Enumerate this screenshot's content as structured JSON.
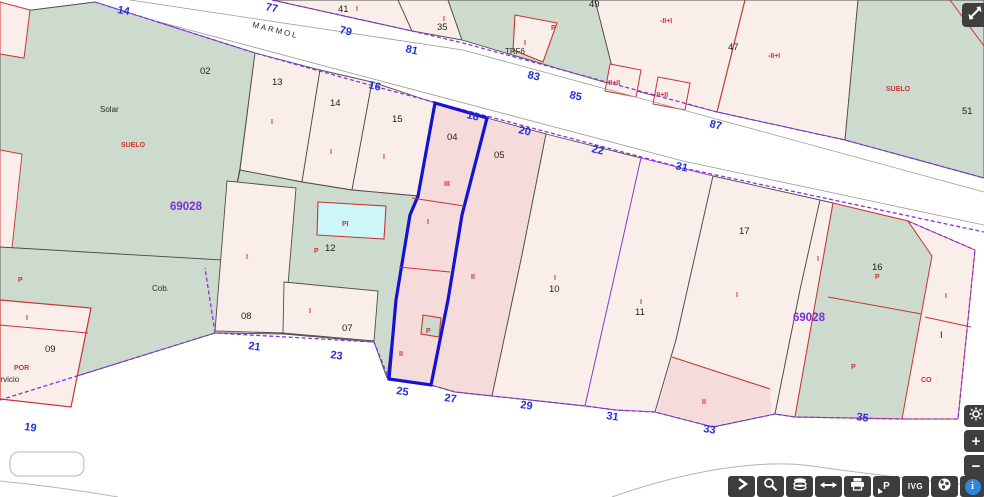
{
  "map": {
    "street_name": "MARMOL",
    "block_number": "69028",
    "colors": {
      "parcel_green": "#ccdbce",
      "parcel_pink": "#faeeeb",
      "parcel_pink_dark": "#f5dcda",
      "pool_cyan": "#cdf7f7",
      "boundary_purple": "#8833dd",
      "selected_blue": "#1512d0",
      "red_line": "#cc3333",
      "label_blue": "#2331d8",
      "label_red": "#d03131",
      "label_purple": "#7b2fd6"
    },
    "labels": {
      "street_numbers": [
        {
          "t": "14",
          "x": 117,
          "y": 13,
          "r": 10
        },
        {
          "t": "77",
          "x": 265,
          "y": 10,
          "r": 12
        },
        {
          "t": "79",
          "x": 339,
          "y": 33,
          "r": 13
        },
        {
          "t": "81",
          "x": 405,
          "y": 52,
          "r": 13
        },
        {
          "t": "83",
          "x": 527,
          "y": 78,
          "r": 13
        },
        {
          "t": "85",
          "x": 569,
          "y": 98,
          "r": 13
        },
        {
          "t": "87",
          "x": 709,
          "y": 127,
          "r": 13
        },
        {
          "t": "16",
          "x": 368,
          "y": 88,
          "r": 13
        },
        {
          "t": "18",
          "x": 466,
          "y": 118,
          "r": 13
        },
        {
          "t": "20",
          "x": 518,
          "y": 133,
          "r": 13
        },
        {
          "t": "22",
          "x": 591,
          "y": 152,
          "r": 13
        },
        {
          "t": "31",
          "x": 675,
          "y": 169,
          "r": 13
        },
        {
          "t": "21",
          "x": 248,
          "y": 349,
          "r": 8
        },
        {
          "t": "23",
          "x": 330,
          "y": 358,
          "r": 8
        },
        {
          "t": "25",
          "x": 396,
          "y": 394,
          "r": 8
        },
        {
          "t": "27",
          "x": 444,
          "y": 401,
          "r": 8
        },
        {
          "t": "29",
          "x": 520,
          "y": 408,
          "r": 8
        },
        {
          "t": "31",
          "x": 606,
          "y": 419,
          "r": 8
        },
        {
          "t": "33",
          "x": 703,
          "y": 432,
          "r": 8
        },
        {
          "t": "35",
          "x": 856,
          "y": 420,
          "r": 8
        },
        {
          "t": "19",
          "x": 24,
          "y": 430,
          "r": 8
        }
      ],
      "parcel_numbers": [
        {
          "t": "02",
          "x": 200,
          "y": 74
        },
        {
          "t": "13",
          "x": 272,
          "y": 85
        },
        {
          "t": "14",
          "x": 330,
          "y": 106
        },
        {
          "t": "15",
          "x": 392,
          "y": 122
        },
        {
          "t": "04",
          "x": 447,
          "y": 140
        },
        {
          "t": "05",
          "x": 494,
          "y": 158
        },
        {
          "t": "10",
          "x": 549,
          "y": 292
        },
        {
          "t": "11",
          "x": 635,
          "y": 315
        },
        {
          "t": "17",
          "x": 739,
          "y": 234
        },
        {
          "t": "16",
          "x": 872,
          "y": 270
        },
        {
          "t": "08",
          "x": 241,
          "y": 319
        },
        {
          "t": "07",
          "x": 342,
          "y": 331
        },
        {
          "t": "09",
          "x": 45,
          "y": 352
        },
        {
          "t": "12",
          "x": 325,
          "y": 251
        },
        {
          "t": "41",
          "x": 338,
          "y": 12
        },
        {
          "t": "35",
          "x": 437,
          "y": 30
        },
        {
          "t": "49",
          "x": 589,
          "y": 7
        },
        {
          "t": "47",
          "x": 728,
          "y": 50
        },
        {
          "t": "51",
          "x": 962,
          "y": 114
        },
        {
          "t": "I",
          "x": 940,
          "y": 338
        }
      ],
      "area_labels": [
        {
          "t": "Solar",
          "x": 100,
          "y": 112
        },
        {
          "t": "Cob.",
          "x": 152,
          "y": 291
        },
        {
          "t": "servicio",
          "x": -8,
          "y": 382
        },
        {
          "t": "TRF6",
          "x": 505,
          "y": 54
        },
        {
          "t": "MARMOL",
          "x": 252,
          "y": 27,
          "r": 14,
          "ls": 2
        }
      ],
      "red_labels": [
        {
          "t": "SUELO",
          "x": 121,
          "y": 147
        },
        {
          "t": "SUELO",
          "x": 886,
          "y": 91
        },
        {
          "t": "POR",
          "x": 14,
          "y": 370,
          "s": 8
        },
        {
          "t": "CO",
          "x": 921,
          "y": 382
        },
        {
          "t": "PI",
          "x": 342,
          "y": 226
        },
        {
          "t": "III",
          "x": 444,
          "y": 186
        },
        {
          "t": "I",
          "x": 271,
          "y": 124
        },
        {
          "t": "I",
          "x": 330,
          "y": 154
        },
        {
          "t": "I",
          "x": 383,
          "y": 159
        },
        {
          "t": "I",
          "x": 427,
          "y": 224
        },
        {
          "t": "I",
          "x": 554,
          "y": 280
        },
        {
          "t": "I",
          "x": 640,
          "y": 304
        },
        {
          "t": "I",
          "x": 736,
          "y": 297
        },
        {
          "t": "I",
          "x": 817,
          "y": 261
        },
        {
          "t": "I",
          "x": 945,
          "y": 298
        },
        {
          "t": "I",
          "x": 443,
          "y": 21
        },
        {
          "t": "I",
          "x": 356,
          "y": 11
        },
        {
          "t": "I",
          "x": 524,
          "y": 45
        },
        {
          "t": "I",
          "x": 246,
          "y": 259
        },
        {
          "t": "I",
          "x": 309,
          "y": 313
        },
        {
          "t": "I",
          "x": 26,
          "y": 320
        },
        {
          "t": "II",
          "x": 471,
          "y": 279
        },
        {
          "t": "II",
          "x": 399,
          "y": 356
        },
        {
          "t": "II",
          "x": 702,
          "y": 404
        },
        {
          "t": "-II+I",
          "x": 660,
          "y": 23
        },
        {
          "t": "-II+I",
          "x": 768,
          "y": 58
        },
        {
          "t": "-II+II",
          "x": 606,
          "y": 85,
          "s": 6.5
        },
        {
          "t": "-II+II",
          "x": 654,
          "y": 97,
          "s": 6.5
        },
        {
          "t": "P",
          "x": 18,
          "y": 282
        },
        {
          "t": "P",
          "x": 314,
          "y": 253
        },
        {
          "t": "P",
          "x": 426,
          "y": 333,
          "s": 6.5
        },
        {
          "t": "P",
          "x": 875,
          "y": 279
        },
        {
          "t": "P",
          "x": 851,
          "y": 369
        },
        {
          "t": "P",
          "x": 551,
          "y": 30
        }
      ],
      "block_numbers": [
        {
          "t": "69028",
          "x": 170,
          "y": 210
        },
        {
          "t": "69028",
          "x": 793,
          "y": 321
        }
      ]
    }
  },
  "controls": {
    "fullscreen": {
      "icon": "expand-icon"
    },
    "settings": {
      "icon": "gear-icon"
    },
    "zoom_in": {
      "label": "+"
    },
    "zoom_out": {
      "label": "−"
    },
    "toolbar": {
      "buttons": [
        {
          "name": "expand-panel-button",
          "icon": "chevron-right-icon"
        },
        {
          "name": "zoom-search-button",
          "icon": "magnifier-icon"
        },
        {
          "name": "layers-button",
          "icon": "layers-icon"
        },
        {
          "name": "measure-button",
          "icon": "horizontal-arrow-icon"
        },
        {
          "name": "print-button",
          "icon": "printer-icon"
        },
        {
          "name": "point-tool-button",
          "icon": "p-cursor-icon",
          "glyph": "P"
        },
        {
          "name": "ivg-button",
          "label": "IVG"
        },
        {
          "name": "globe-button",
          "icon": "globe-icon"
        },
        {
          "name": "info-button",
          "icon": "info-icon",
          "glyph": "i"
        }
      ]
    }
  }
}
